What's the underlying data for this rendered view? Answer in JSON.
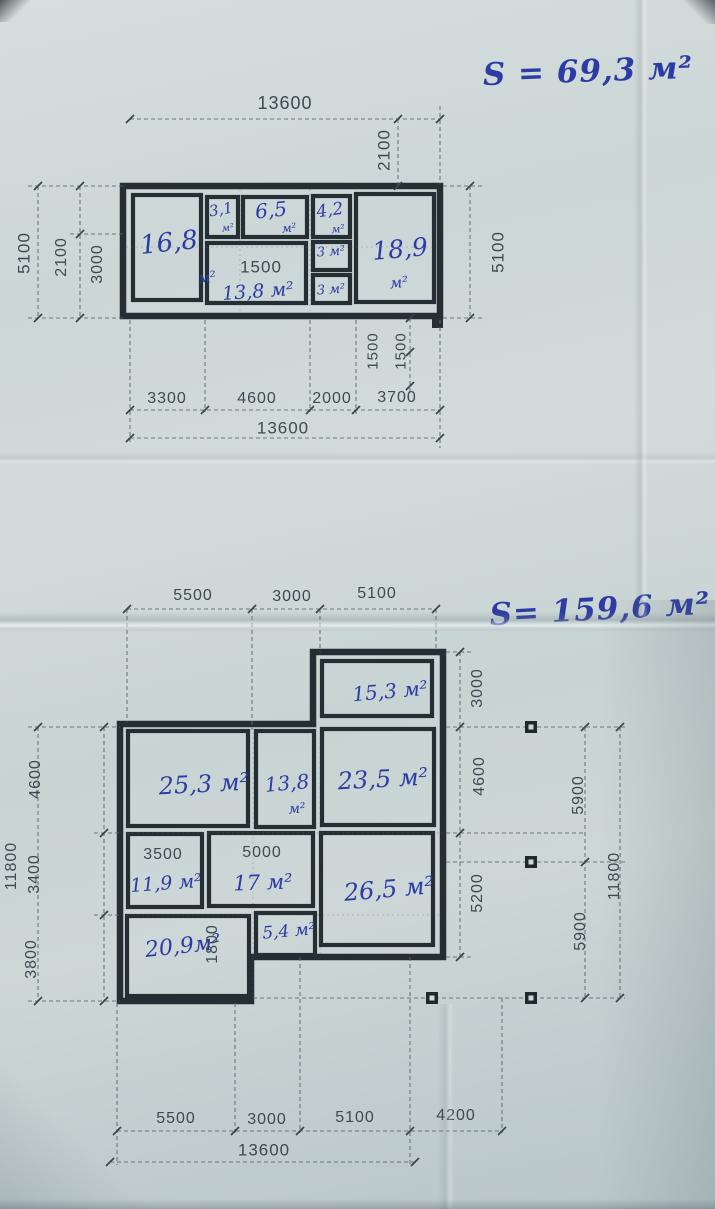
{
  "colors": {
    "paper": "#cbd5d6",
    "wall_ink": "#242e33",
    "printed_ink": "#3e4951",
    "pen_ink": "#2d3ca4"
  },
  "plan_top": {
    "area_label": "S = 69,3 м²",
    "dims": {
      "top_total": "13600",
      "top_right_vertical": "2100",
      "left_outer": "5100",
      "left_inner": [
        "2100",
        "3000"
      ],
      "right_outer": "5100",
      "below_right": [
        "1500",
        "1500"
      ],
      "bottom_row": [
        "3300",
        "4600",
        "2000",
        "3700"
      ],
      "bottom_total": "13600"
    },
    "rooms": [
      {
        "area": "16,8",
        "unit": "м²"
      },
      {
        "area": "3,1",
        "unit": "м²"
      },
      {
        "area": "6,5",
        "unit": "м²"
      },
      {
        "area": "4,2",
        "unit": "м²"
      },
      {
        "area": "13,8 м²",
        "printed_dim": "1500"
      },
      {
        "area": "3 м²"
      },
      {
        "area": "3 м²"
      },
      {
        "area": "18,9",
        "unit": "м²"
      }
    ]
  },
  "plan_bottom": {
    "area_label": "S= 159,6 м²",
    "dims": {
      "top_row": [
        "5500",
        "3000",
        "5100"
      ],
      "left_outer": "11800",
      "left_inner": [
        "4600",
        "3400",
        "3800"
      ],
      "right_inner": [
        "3000",
        "4600",
        "5200"
      ],
      "right_mid": [
        "5900",
        "5900"
      ],
      "right_outer": "11800",
      "bottom_row": [
        "5500",
        "3000",
        "5100",
        "4200"
      ],
      "bottom_total": "13600"
    },
    "rooms": [
      {
        "area": "15,3 м²"
      },
      {
        "area": "25,3 м²"
      },
      {
        "area": "13,8",
        "unit": "м²"
      },
      {
        "area": "23,5 м²"
      },
      {
        "area": "11,9 м²",
        "printed_dim": "3500"
      },
      {
        "area": "17 м²",
        "printed_dim": "5000"
      },
      {
        "area": "26,5 м²"
      },
      {
        "area": "20,9м²",
        "printed_dim_vertical": "1800"
      },
      {
        "area": "5,4 м²"
      }
    ]
  }
}
